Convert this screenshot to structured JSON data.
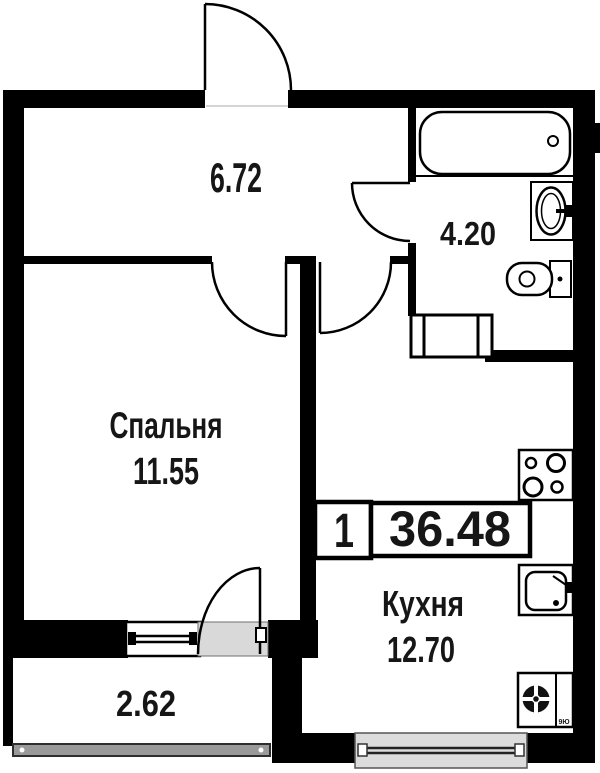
{
  "plan": {
    "type": "apartment-floor-plan",
    "badge": {
      "rooms_count": "1",
      "total_area": "36.48"
    },
    "rooms": {
      "hallway": {
        "area": "6.72"
      },
      "bathroom": {
        "area": "4.20"
      },
      "bedroom": {
        "name": "Спальня",
        "area": "11.55"
      },
      "kitchen": {
        "name": "Кухня",
        "area": "12.70"
      },
      "balcony": {
        "area": "2.62"
      }
    },
    "vent_label": "9Ю",
    "fixtures": [
      "bathtub-icon",
      "bathroom-sink-icon",
      "toilet-icon",
      "washing-machine-icon",
      "stove-icon",
      "kitchen-sink-icon",
      "vent-shaft-icon"
    ],
    "colors": {
      "wall": "#000000",
      "text": "#161616",
      "threshold": "#d9d9d9",
      "window_fill": "#dcdcdc",
      "glazing": "#9a9a9a"
    }
  }
}
